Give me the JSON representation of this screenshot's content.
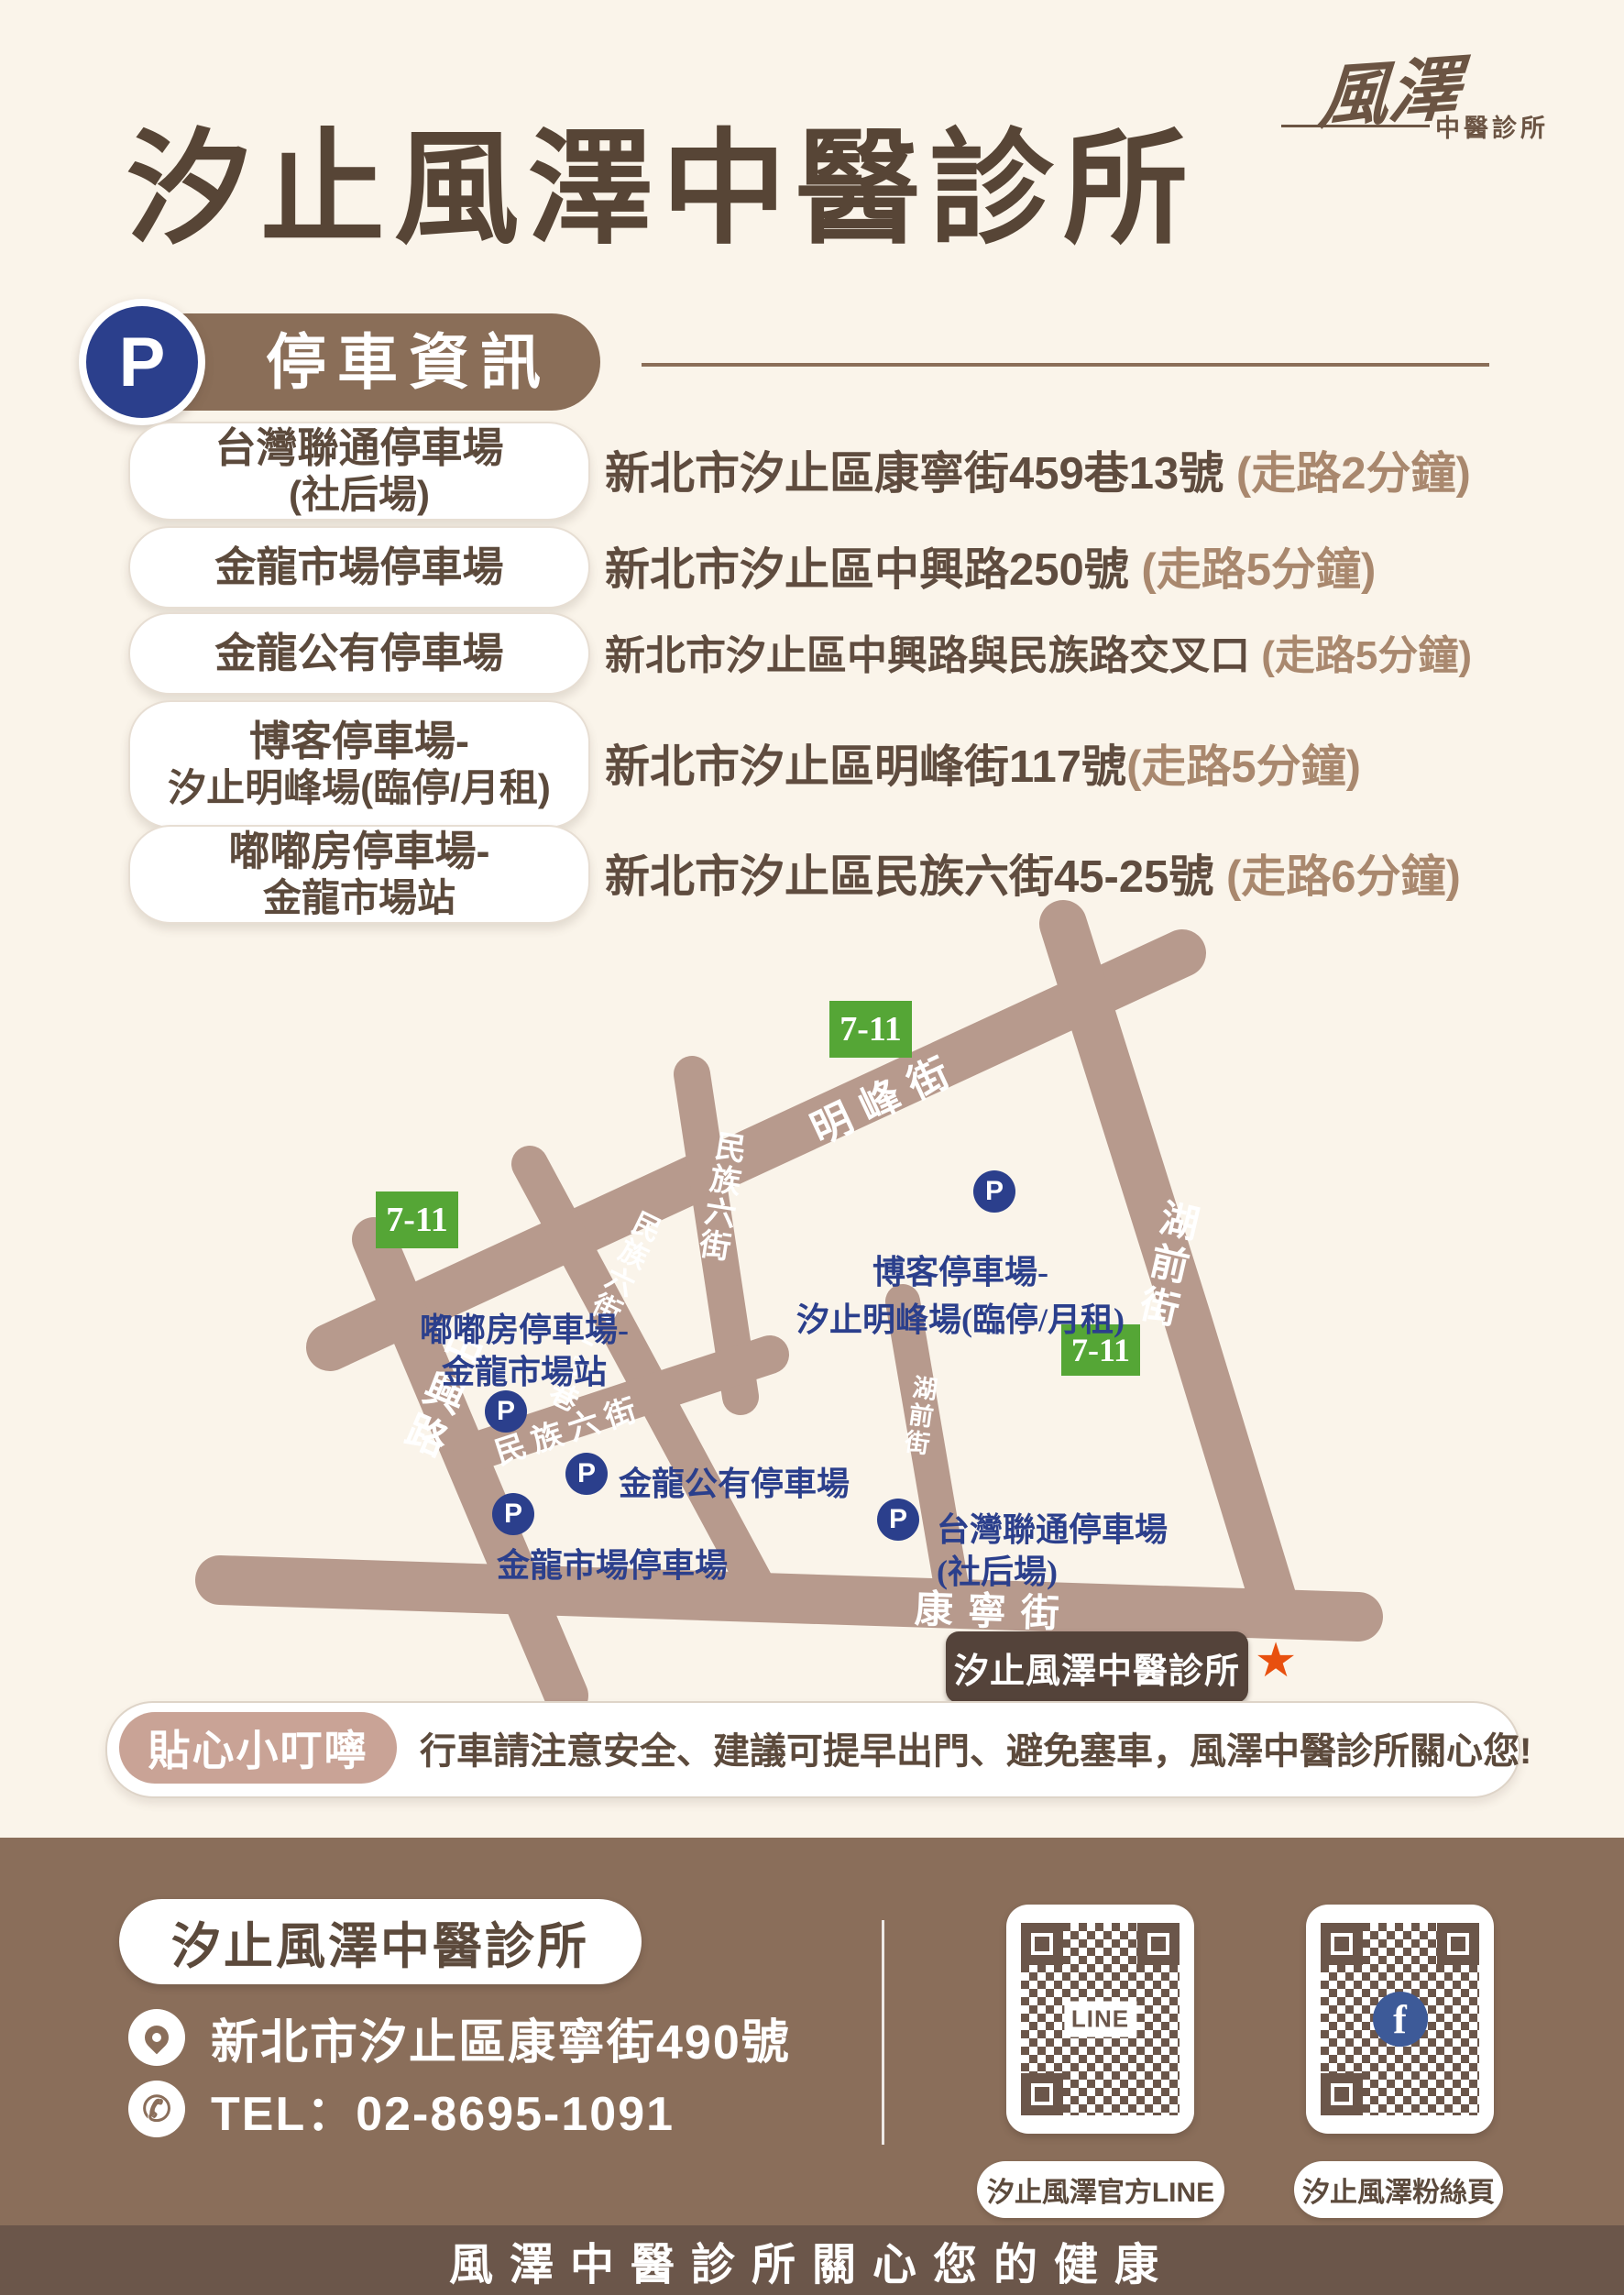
{
  "colors": {
    "background": "#faf4ea",
    "title_brown": "#574536",
    "section_brown": "#8a6e58",
    "street_tan": "#b79a8d",
    "p_blue": "#2b3f8c",
    "seven_green": "#55a636",
    "map_label_blue": "#2b3f8c",
    "clinic_box_brown": "#54433a",
    "star_orange": "#e8500f",
    "reminder_badge_rose": "#c9a396",
    "footer_brown": "#8a6e5a",
    "footer_strip_brown": "#6b564a",
    "walk_time_brown": "#a9886e",
    "fb_blue": "#3d5a98"
  },
  "header": {
    "title": "汐止風澤中醫診所",
    "logo_main": "風澤",
    "logo_sub": "中醫診所"
  },
  "parking": {
    "badge_letter": "P",
    "heading": "停車資訊",
    "items": [
      {
        "name_line1": "台灣聯通停車場",
        "name_line2": "(社后場)",
        "address": "新北市汐止區康寧街459巷13號",
        "walk": " (走路2分鐘)"
      },
      {
        "name_line1": "金龍市場停車場",
        "name_line2": "",
        "address": "新北市汐止區中興路250號",
        "walk": " (走路5分鐘)"
      },
      {
        "name_line1": "金龍公有停車場",
        "name_line2": "",
        "address": "新北市汐止區中興路與民族路交叉口",
        "walk": " (走路5分鐘)"
      },
      {
        "name_line1": "博客停車場-",
        "name_line2": "汐止明峰場(臨停/月租)",
        "address": "新北市汐止區明峰街117號",
        "walk": "(走路5分鐘)"
      },
      {
        "name_line1": "嘟嘟房停車場-",
        "name_line2": "金龍市場站",
        "address": "新北市汐止區民族六街45-25號",
        "walk": " (走路6分鐘)"
      }
    ]
  },
  "map": {
    "street_mingfeng": "明峰街",
    "street_huqian": "湖前街",
    "street_huqian_small": "湖前街",
    "street_zhongxing": "中興路",
    "street_minzu6_h": "民族六街",
    "street_minzu6_v": "民族六街",
    "street_minzu6_23": "民族六街23巷",
    "street_kangning": "康寧街",
    "seven_eleven": "7-11",
    "p_letter": "P",
    "parking_boke_line1": "博客停車場-",
    "parking_boke_line2": "汐止明峰場(臨停/月租)",
    "parking_dudu_line1": "嘟嘟房停車場-",
    "parking_dudu_line2": "金龍市場站",
    "parking_gongyou": "金龍公有停車場",
    "parking_shichang": "金龍市場停車場",
    "parking_taiwan_line1": "台灣聯通停車場",
    "parking_taiwan_line2": "(社后場)",
    "clinic_label": "汐止風澤中醫診所",
    "star": "★"
  },
  "reminder": {
    "badge": "貼心小叮嚀",
    "message": "行車請注意安全、建議可提早出門、避免塞車，風澤中醫診所關心您!"
  },
  "footer": {
    "clinic_name": "汐止風澤中醫診所",
    "address": "新北市汐止區康寧街490號",
    "tel": "TEL：02-8695-1091",
    "line_qr_center": "LINE",
    "fb_qr_center": "f",
    "line_qr_label": "汐止風澤官方LINE",
    "fb_qr_label": "汐止風澤粉絲頁",
    "slogan": "風澤中醫診所關心您的健康"
  }
}
